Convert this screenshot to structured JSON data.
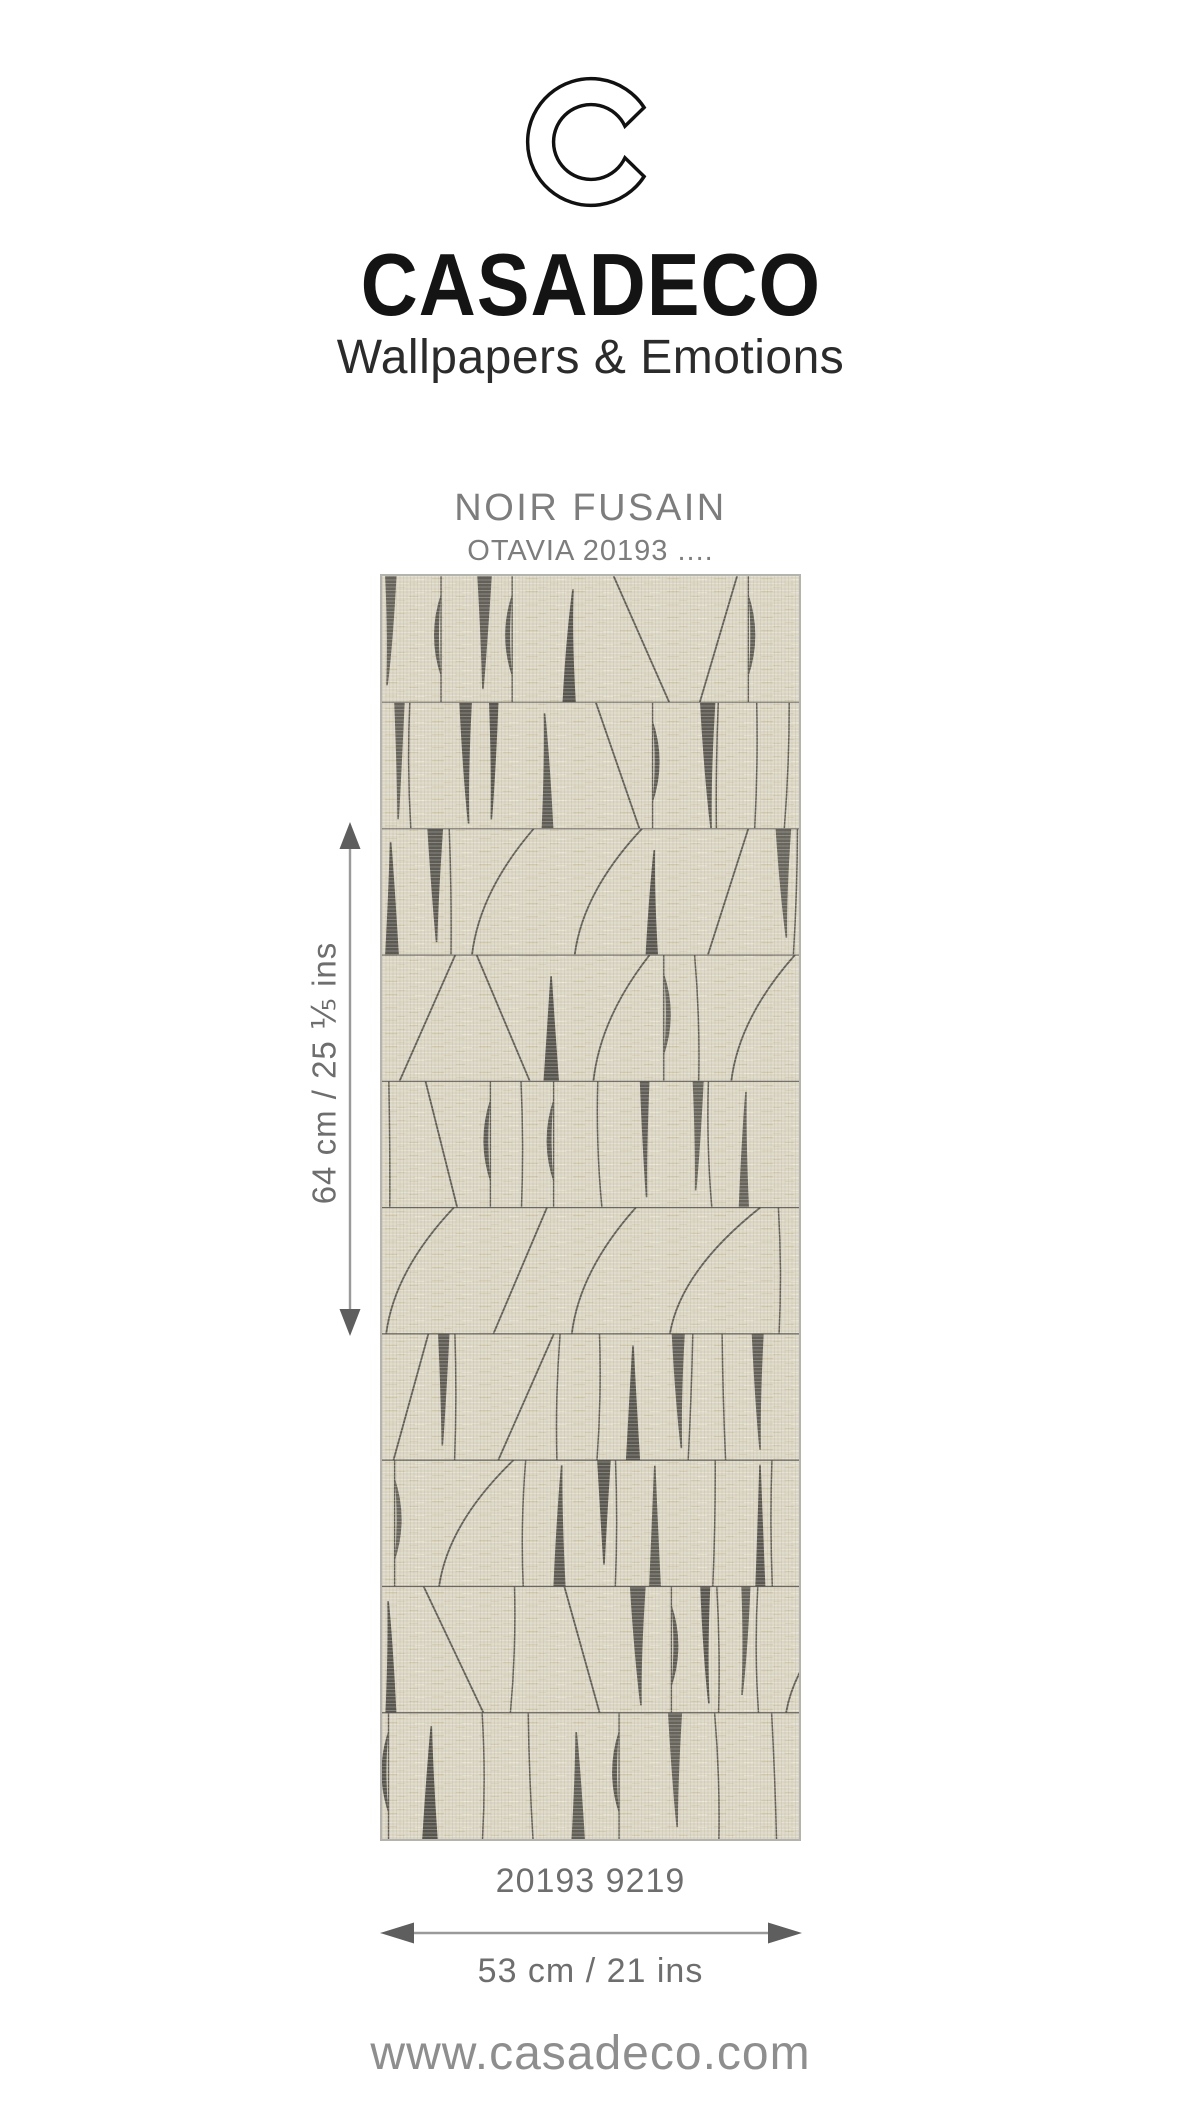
{
  "brand": {
    "logo_letter": "C",
    "name": "CASADECO",
    "tagline": "Wallpapers & Emotions"
  },
  "product": {
    "title": "NOIR FUSAIN",
    "subtitle": "OTAVIA 20193 ....",
    "reference": "20193 9219"
  },
  "dimensions": {
    "height_label": "64 cm / 25 ⅕ ins",
    "width_label": "53 cm / 21 ins",
    "arrow_line_color": "#9a9a9a",
    "arrow_head_color": "#5e5e5e"
  },
  "footer": {
    "website": "www.casadeco.com"
  },
  "swatch": {
    "description": "charcoal tapered strokes on beige linen, 10 horizontal bands",
    "rows": 10,
    "seed": 20193,
    "width": 417,
    "height": 1263,
    "colors": {
      "background": "#dcd7c5",
      "ink": "#55534c",
      "separator": "#57554e",
      "thread_warm": "#c8b88c",
      "thread_light": "#efe9d5",
      "weave_light": "#ffffff",
      "weave_dark": "#6e6450",
      "border": "#b5b3ae"
    }
  }
}
